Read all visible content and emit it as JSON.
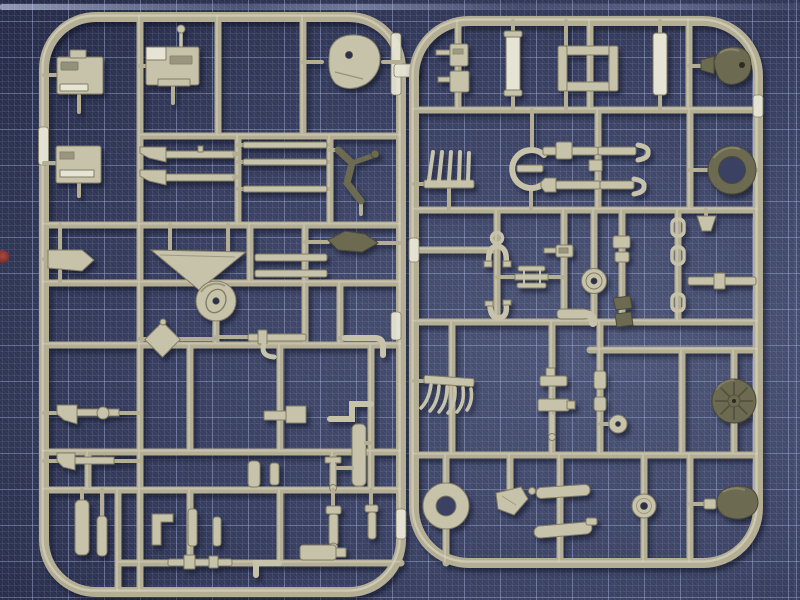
{
  "scene": {
    "type": "photograph",
    "setting": "top-down photo of two injection-molded plastic model-kit sprues lying side by side on a dark blue self-healing cutting mat with a printed square grid",
    "description": "Two pale olive-khaki model kit sprues (runner frames full of small military accessory parts) photographed on a dark navy cutting mat with fine crosshatch texture and light blue grid lines; a small red paint mark sits on the left mat edge and a light mat edge line runs along the top.",
    "mat": {
      "kind": "self-healing cutting mat",
      "grid": "36px square grid over a fine 6px crosshatch weave",
      "marks": [
        "small red paint mark on left edge",
        "light horizontal mat edge line along top"
      ]
    },
    "sprues": [
      {
        "id": "left-sprue",
        "plastic_color": "pale olive-khaki",
        "shape": "rounded-rectangle frame with internal runner lattice",
        "notable_parts": [
          "machine-gun receiver blocks (3)",
          "round hatch plate with hole",
          "rifle bodies (2)",
          "straight rods (3)",
          "dark angled lever",
          "L-bracket",
          "triangular gusset plate",
          "road wheel with hub",
          "diamond-shaped mounting plate",
          "rod with elbow hook",
          "short rifles (2)",
          "stepped block",
          "L-bend strip",
          "T-pin",
          "vertical plugs and pins",
          "pipe elbow",
          "fitted rods",
          "bright mold tags on rails"
        ]
      },
      {
        "id": "right-sprue",
        "plastic_color": "pale olive-khaki",
        "shape": "rounded-rectangle frame with internal runner lattice",
        "notable_parts": [
          "gun bodies (2)",
          "bright vertical strips (2)",
          "rectangular ladder frame",
          "dark bell-shaped knob",
          "toothed rake comb",
          "G-shaped clamp ring",
          "rods with claw ends (2)",
          "dark tire ring",
          "ring-and-yoke links",
          "biplane-profile bracket",
          "small hub disc",
          "shackle links (3)",
          "rod with fitting",
          "curved-tooth rake",
          "T-brackets",
          "small ball disc",
          "dark spoked wheel",
          "flat annulus ring",
          "angled bracket",
          "blade wing parts (2)",
          "washer disc",
          "dark dome"
        ]
      }
    ],
    "palette": {
      "mat_light": "#4e5678",
      "mat_mid": "#3a4162",
      "mat_dark": "#272c49",
      "mat_hole": "#2b3050",
      "grid_line": "#99a4ca",
      "grid_fine": "#6d78a0",
      "runner": "#b3ae94",
      "runner_hi": "#dcd9c5",
      "part_base": "#c7c3ab",
      "part_bright": "#e6e4d4",
      "part_edge": "#827d64",
      "part_dark": "#6c6a51",
      "part_dark_edge": "#4b4a38",
      "part_dark_hi": "#908e73",
      "red_mark": "#8a3431"
    }
  }
}
